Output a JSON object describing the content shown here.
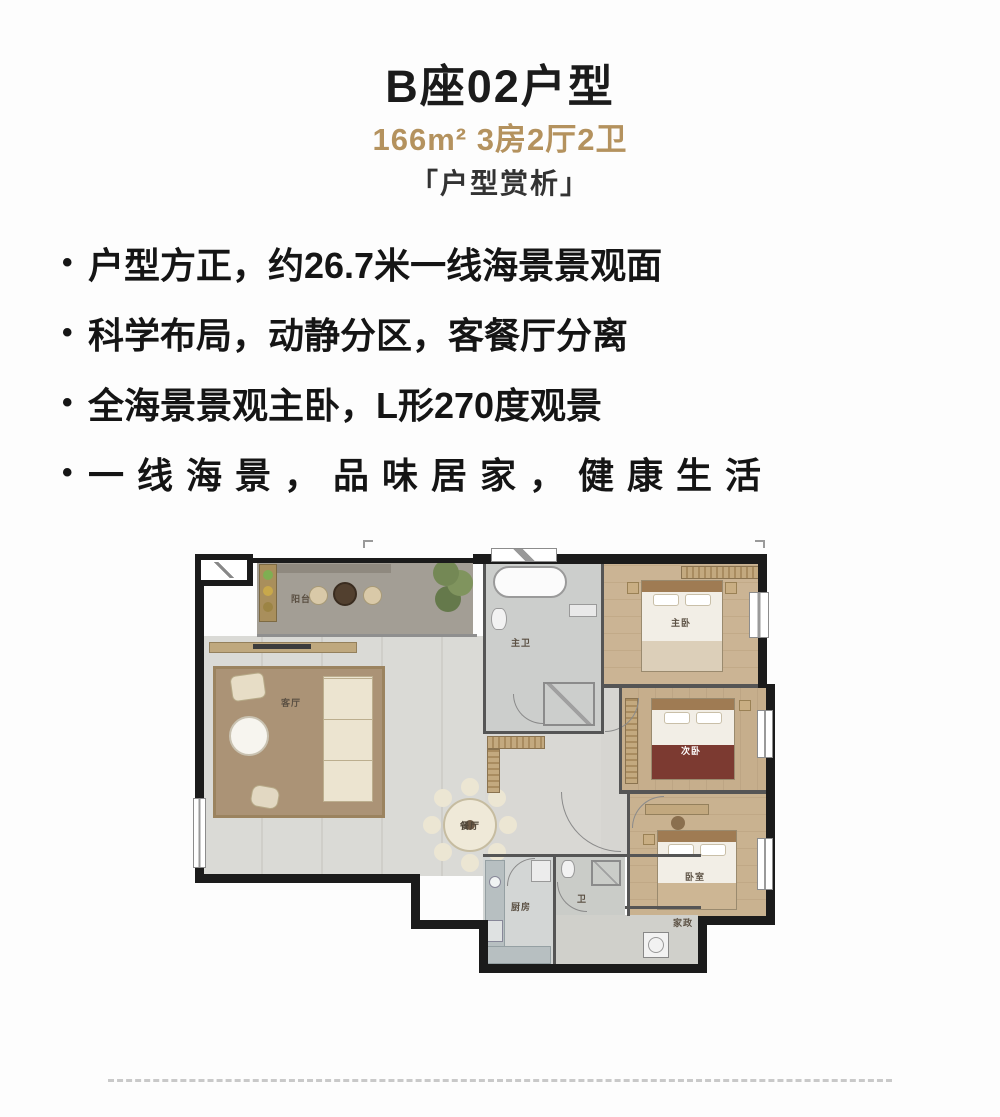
{
  "header": {
    "title": "B座02户型",
    "subtitle": "166m² 3房2厅2卫",
    "tagline": "「户型赏析」"
  },
  "bullets": {
    "marker": "•",
    "items": [
      "户型方正，约26.7米一线海景景观面",
      "科学布局，动静分区，客餐厅分离",
      "全海景景观主卧，L形270度观景",
      "一线海景，品味居家，健康生活"
    ]
  },
  "floor_plan": {
    "rooms": {
      "balcony": "阳台",
      "living": "客厅",
      "dining": "餐厅",
      "master_bath": "主卫",
      "master_bedroom": "主卧",
      "bedroom2": "次卧",
      "bedroom3": "卧室",
      "kitchen": "厨房",
      "bath2": "卫",
      "utility": "家政"
    }
  },
  "colors": {
    "accent_gold": "#b4925e",
    "wall_black": "#1b1b1b",
    "text_black": "#141414"
  }
}
